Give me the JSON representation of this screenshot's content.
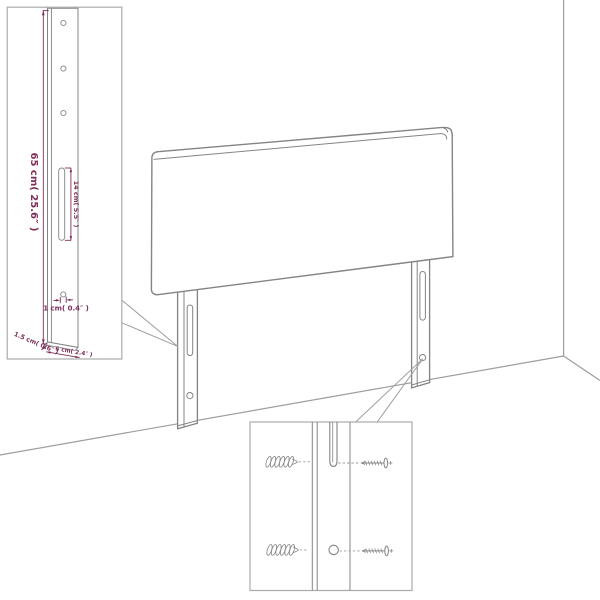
{
  "left_detail": {
    "height_label": "65 cm( 25.6″ )",
    "slot_label": "14 cm( 5.5″ )",
    "hole_label": "1 cm( 0.4″ )",
    "depth_label": "1.5 cm( 0.6″ )",
    "width_label": "6 cm( 2.4″ )"
  },
  "right_detail": {
    "hardware_icons": [
      "wall-plug-icon",
      "screw-icon"
    ]
  },
  "colors": {
    "dimension_text": "#7E2E5A",
    "drawing_line": "#848484",
    "room_line": "#9E9E9E",
    "callout_border": "#ABABAB",
    "background": "#FFFFFF"
  }
}
